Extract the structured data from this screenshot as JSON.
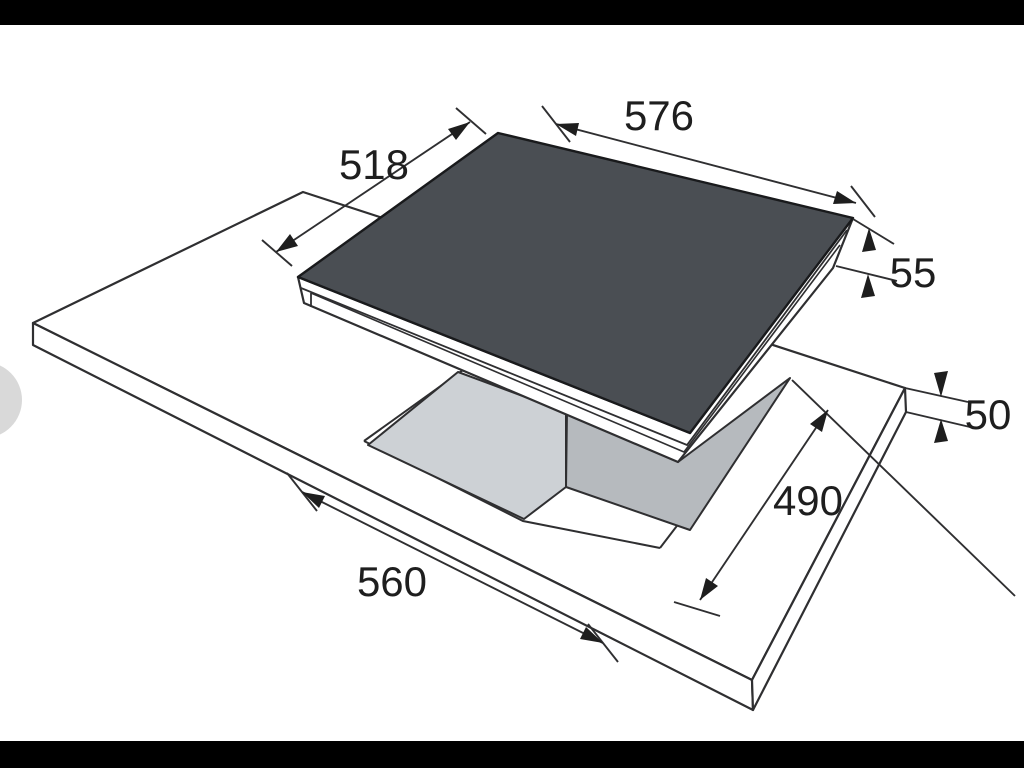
{
  "figure": {
    "type": "technical-installation-drawing",
    "subject": "built-in hob and worktop cutout"
  },
  "dims": {
    "hob_width": "576",
    "hob_depth": "518",
    "hob_height": "55",
    "worktop_thickness": "50",
    "cutout_depth": "490",
    "cutout_width": "560"
  },
  "colors": {
    "glass_top": "#4a4e53",
    "cutout_wall_light": "#cdd1d5",
    "cutout_wall_dark": "#b6babe",
    "line": "#2f2f31",
    "letterbox_bar": "#000000",
    "edge_handle": "#d9d9d9",
    "background": "#ffffff"
  }
}
